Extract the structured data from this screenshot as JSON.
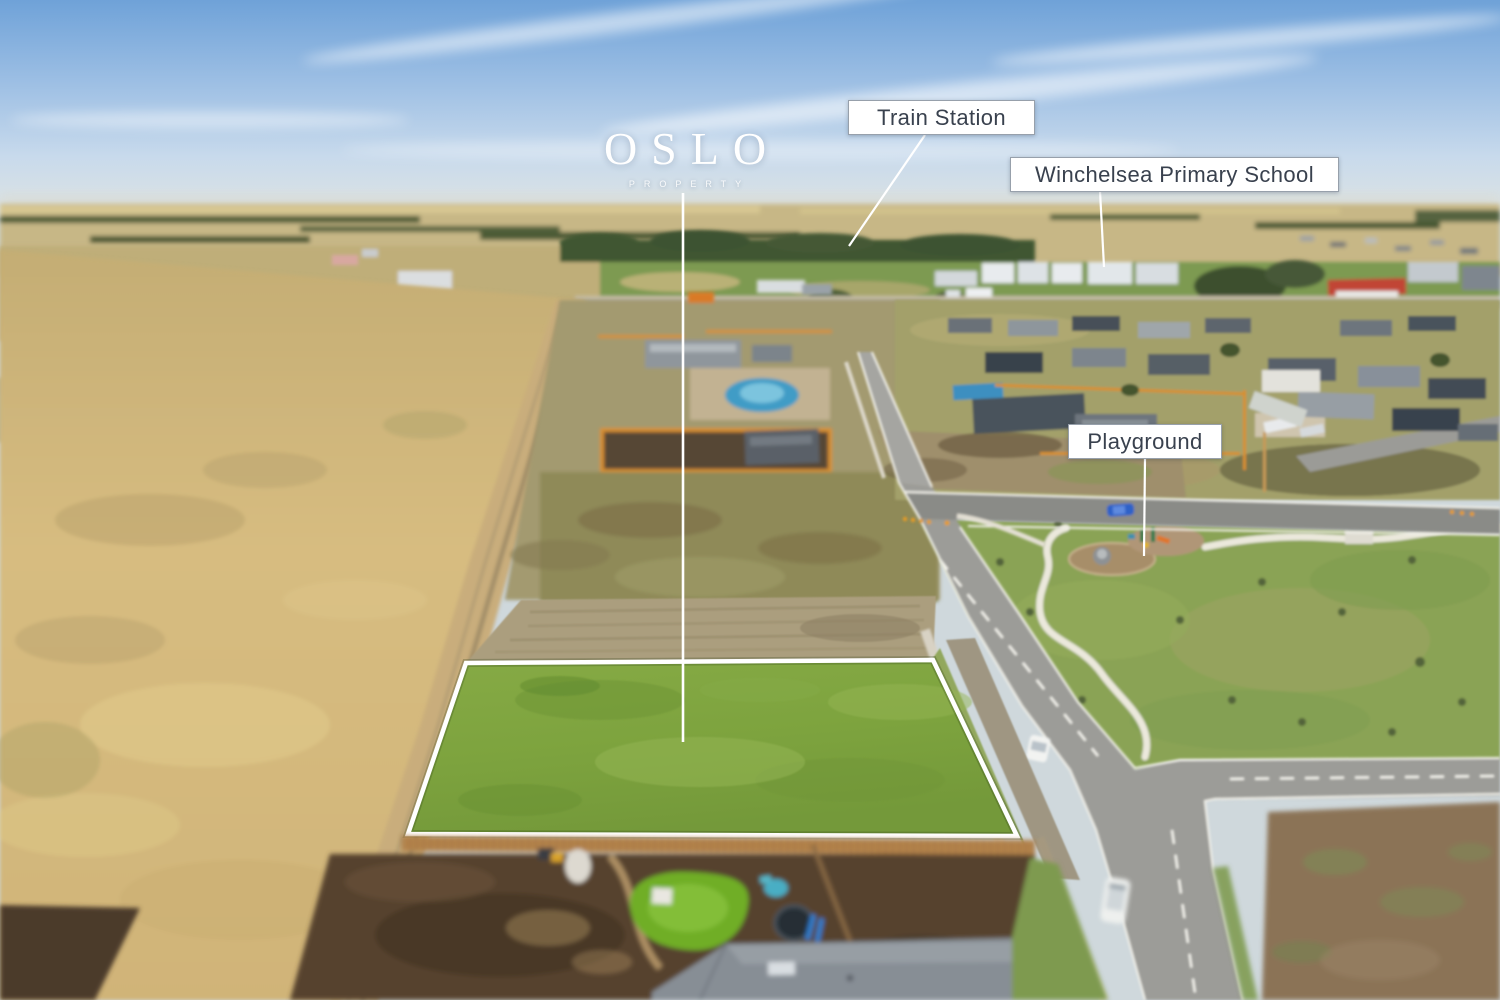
{
  "annotations": {
    "logo": {
      "text": "OSLO",
      "subtext": "PROPERTY"
    },
    "callouts": [
      {
        "id": "train-station",
        "label": "Train Station"
      },
      {
        "id": "winchelsea-primary-school",
        "label": "Winchelsea Primary School"
      },
      {
        "id": "playground",
        "label": "Playground"
      }
    ]
  },
  "scene": {
    "type": "aerial-drone-photo-with-callouts",
    "highlighted_lot": {
      "shape": "trapezoid",
      "outline_color": "#ffffff"
    },
    "colors": {
      "sky_top": "#6fa2d8",
      "sky_horizon": "#dfe4e2",
      "dry_paddock": "#d3b77c",
      "lot_grass": "#7fa73f",
      "park_grass": "#8aa355",
      "road_asphalt": "#9c9c98",
      "timber_fence": "#b5854e",
      "label_text": "#39414e",
      "label_border": "#97a0ab",
      "callout_line": "#ffffff"
    }
  }
}
